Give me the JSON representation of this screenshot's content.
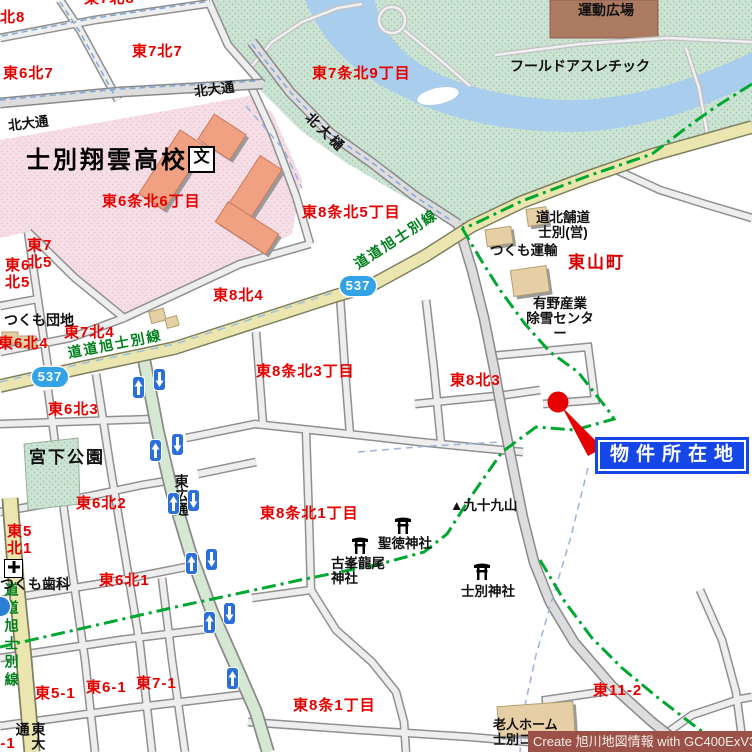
{
  "map_title": "士別市 物件案内図",
  "districts": {
    "kita8": "北8",
    "e7k8": "東7北8",
    "e6k7": "東6北7",
    "e7k7": "東7北7",
    "e7j_k9": "東7条北9丁目",
    "e6j_k6": "東6条北6丁目",
    "e8j_k5": "東8条北5丁目",
    "e7k5": "東7\n北5",
    "e6k5": "東6\n北5",
    "e6k4": "東6北4",
    "e7k4": "東7北4",
    "e8k4": "東8北4",
    "e8j_k3": "東8条北3丁目",
    "e8k3": "東8北3",
    "e6k3": "東6北3",
    "e5k3": "東5\n北3",
    "e6k2": "東6北2",
    "e5k1": "東5\n北1",
    "e6k1": "東6北1",
    "e8j_k1": "東8条北1丁目",
    "e8j_1": "東8条1丁目",
    "e5_1": "東5-1",
    "e6_1": "東6-1",
    "e7_1": "東7-1",
    "e4_1": "東4-1",
    "e11_2": "東11-2",
    "higashiyama": "東山町"
  },
  "streets": {
    "kita_odori_w": "北大通",
    "kita_odori_e": "北大通",
    "kita_ohi": "北大樋",
    "pref_road_w": "道道旭士別線",
    "pref_road_ne": "道道旭士別線",
    "pref_road_s": "道道旭士別線",
    "higashi_hiro_dori": "東広通",
    "higashi_o_dori": "東大通"
  },
  "routes": {
    "r537": "537"
  },
  "places": {
    "school": "士別翔雲高校",
    "school_symbol": "文",
    "tsukumo_danchi": "つくも団地",
    "miyashita_park": "宮下公園",
    "tsukumo_dental": "つくも歯科",
    "field_athletic": "フールドアスレチック",
    "sports_plaza": "運動広場",
    "dohoku_pavement": "道北舗道\n士別(営)",
    "tsukumo_transport": "つくも運輸",
    "arino_snow_center": "有野産業\n除雪センター",
    "mt_tsukumo": "▲九十九山",
    "shotoku_shrine": "聖徳神社",
    "furumine_shrine": "古峯龍尾\n神社",
    "shibetsu_shrine": "士別神社",
    "nursing_home": "老人ホーム\n士別コス"
  },
  "callout": {
    "label": "物件所在地"
  },
  "credit": "Create 旭川地図情報 with GC400ExV3",
  "colors": {
    "water": "#a9cdec",
    "parkland": "#cde4d4",
    "campus_pink": "#f6dee7",
    "route_yellow": "#ebe6b0",
    "boundary_green": "#00a832",
    "marker_red": "#e60000",
    "callout_blue": "#1546e8",
    "shield_blue": "#33a3e8",
    "credit_bg": "#9b5148"
  }
}
